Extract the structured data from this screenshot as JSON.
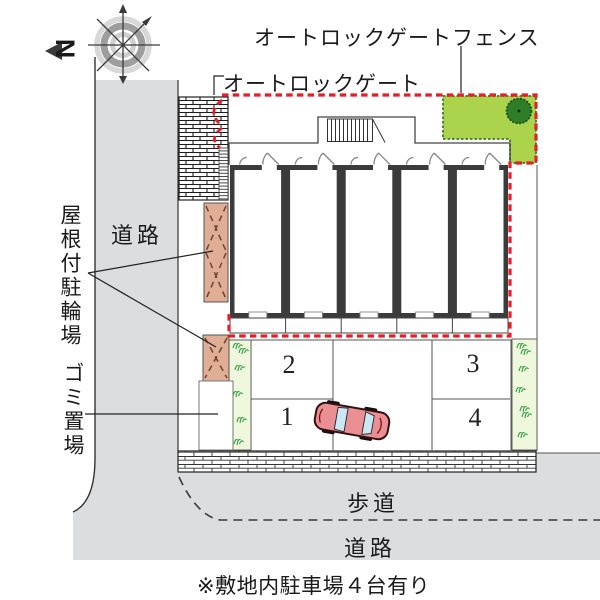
{
  "note": "※敷地内駐車場４台有り",
  "compass": {
    "north_label": "N"
  },
  "labels": {
    "autolock_gate_fence": "オートロックゲートフェンス",
    "autolock_gate": "オートロックゲート",
    "covered_bicycle_parking": "屋根付駐輪場",
    "garbage_area": "ゴミ置場",
    "road_left": "道路",
    "sidewalk": "歩道",
    "road_bottom": "道路"
  },
  "parking": {
    "spaces": [
      {
        "label": "1"
      },
      {
        "label": "2"
      },
      {
        "label": "3"
      },
      {
        "label": "4"
      }
    ]
  },
  "colors": {
    "fence_red": "#e51f29",
    "green_area": "#abd34c",
    "tree_green": "#2e7d27",
    "grass_strip": "#eff7dc",
    "shelter_tan": "#e0ad97",
    "road_gray": "#dcddde",
    "car_body": "#ea8f93",
    "car_window": "#cbe7f3"
  }
}
